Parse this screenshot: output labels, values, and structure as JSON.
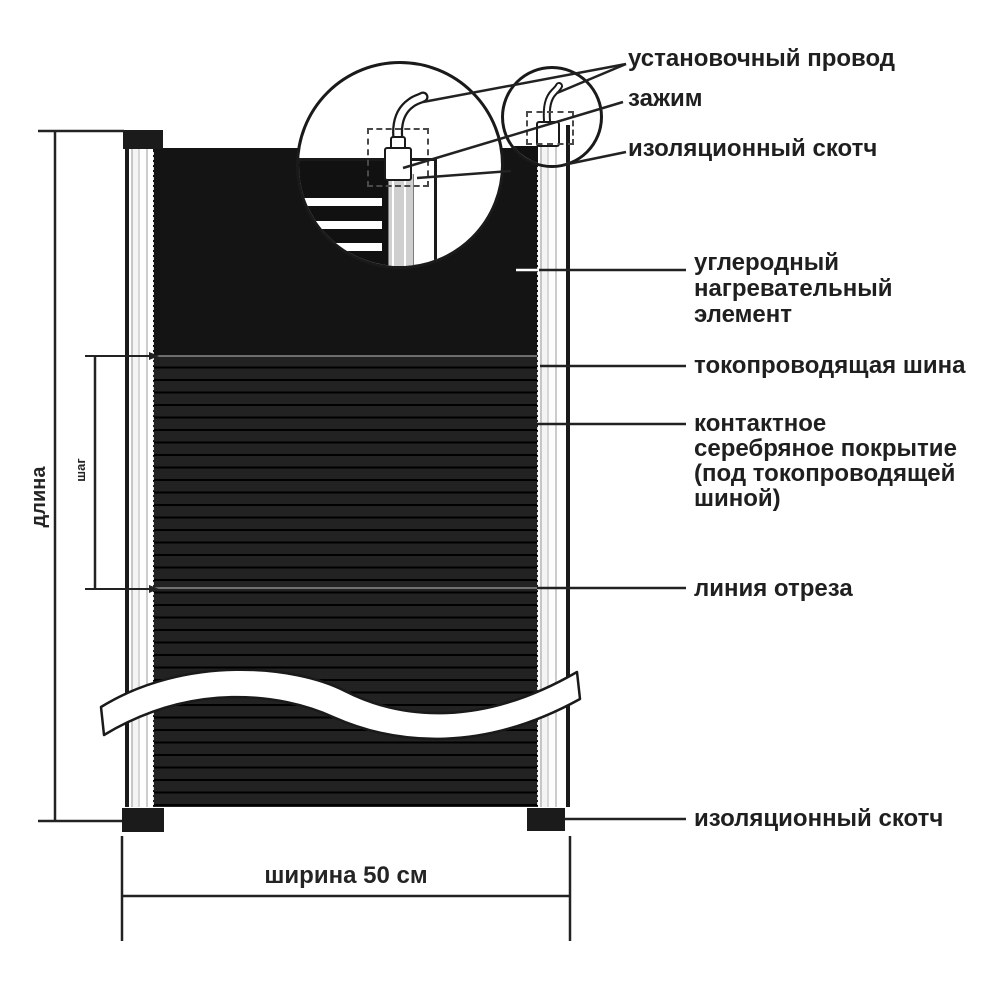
{
  "diagram": {
    "top_labels": [
      {
        "label": "установочный провод"
      },
      {
        "label": "зажим"
      },
      {
        "label": "изоляционный скотч"
      }
    ],
    "right_labels": [
      {
        "lines": [
          "углеродный",
          "нагревательный",
          "элемент"
        ]
      },
      {
        "lines": [
          "токопроводящая шина"
        ]
      },
      {
        "lines": [
          "контактное",
          "серебряное покрытие",
          "(под токопроводящей",
          "шиной)"
        ]
      },
      {
        "lines": [
          "линия отреза"
        ]
      },
      {
        "lines": [
          "изоляционный скотч"
        ]
      }
    ],
    "dimensions": {
      "length": "длина",
      "step": "шаг",
      "width": "ширина 50 см"
    },
    "colors": {
      "film": "#141414",
      "line": "#222222",
      "text": "#1f1f1f",
      "bus": "#ffffff"
    }
  }
}
